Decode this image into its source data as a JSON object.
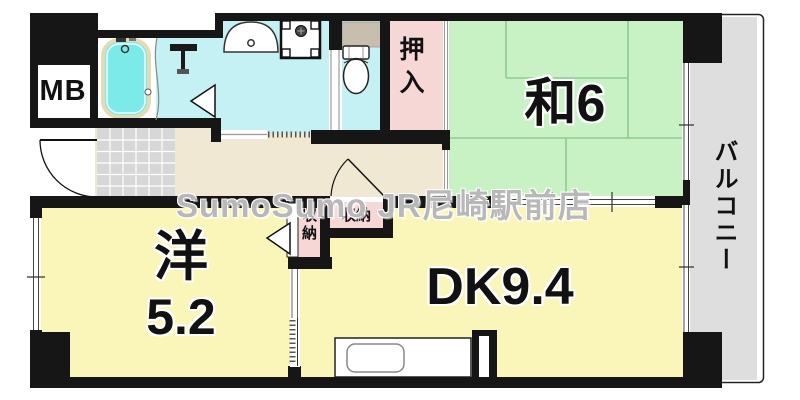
{
  "watermark": {
    "text": "SumoSumo JR尼崎駅前店"
  },
  "labels": {
    "meter_box": "MB",
    "closet_oshiire": "押入",
    "japanese_room": "和6",
    "balcony": "バルコニー",
    "storage_left": "収納",
    "storage_right": "収納",
    "western_room_name": "洋",
    "western_room_size": "5.2",
    "dining_kitchen": "DK9.4"
  },
  "colors": {
    "wall": "#161616",
    "tatami_room": "#c8f2c4",
    "tatami_line": "#8fcb8f",
    "flooring_room": "#faf5b8",
    "closet_pink": "#f7d6d6",
    "wet_area": "#c6f1f4",
    "bathtub_water": "#7deaea",
    "bathtub_rim": "#e6d9b3",
    "hallway": "#f1e8d4",
    "entrance_tile": "#d7d7d7",
    "balcony_floor": "#dedede",
    "toilet_counter": "#c8bead"
  }
}
